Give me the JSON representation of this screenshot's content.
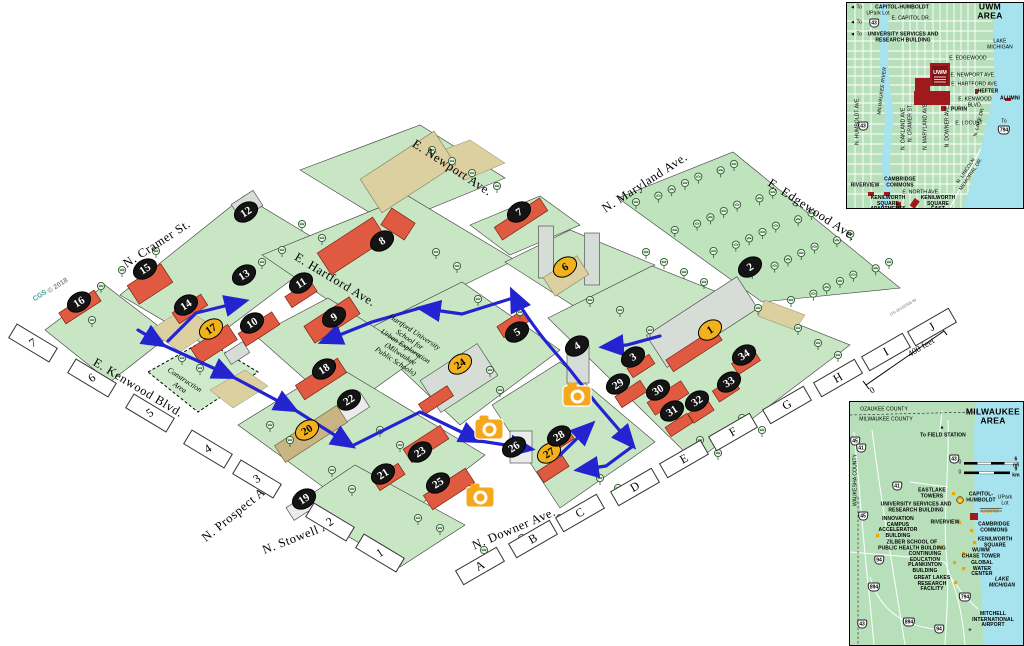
{
  "colors": {
    "route_blue": "#2323cf",
    "marker_yellow": "#f2b21e",
    "marker_black": "#141414",
    "camera_orange": "#f6a81c",
    "land_green": "#c8e6c4",
    "water_cyan": "#a6e3ee",
    "building_coral": "#e05a41",
    "inset_red": "#a01a1d"
  },
  "main_map": {
    "streets": [
      {
        "name": "E. Newport Ave.",
        "x": 452,
        "y": 168,
        "rot": 33
      },
      {
        "name": "N. Maryland Ave.",
        "x": 645,
        "y": 183,
        "rot": -33
      },
      {
        "name": "E. Edgewood Ave.",
        "x": 812,
        "y": 210,
        "rot": 33
      },
      {
        "name": "N. Cramer St.",
        "x": 157,
        "y": 244,
        "rot": -33
      },
      {
        "name": "E. Hartford Ave.",
        "x": 335,
        "y": 280,
        "rot": 31
      },
      {
        "name": "E. Kenwood Blvd.",
        "x": 138,
        "y": 388,
        "rot": 31
      },
      {
        "name": "N. Prospect Ave.",
        "x": 240,
        "y": 510,
        "rot": -39
      },
      {
        "name": "N. Stowell Ave.",
        "x": 304,
        "y": 535,
        "rot": -21
      },
      {
        "name": "N. Downer Ave.",
        "x": 514,
        "y": 529,
        "rot": -23
      }
    ],
    "texts": [
      {
        "t": "CGS",
        "x": 40,
        "y": 296,
        "rot": -33,
        "cls": "wm wm-teal"
      },
      {
        "t": "© 2018",
        "x": 58,
        "y": 286,
        "rot": -33,
        "cls": "wm"
      },
      {
        "t": "Construction\nArea",
        "x": 182,
        "y": 384,
        "rot": 33,
        "cls": "small-italic"
      },
      {
        "t": "Hartford University\nSchool for\nUrban Exploration\n(Milwaukee\nPublic Schools)",
        "x": 405,
        "y": 347,
        "rot": 33,
        "cls": "small-italic"
      },
      {
        "t": "0",
        "x": 872,
        "y": 390,
        "rot": -31,
        "cls": "scale"
      },
      {
        "t": "400 feet",
        "x": 921,
        "y": 347,
        "rot": -31,
        "cls": "scale"
      },
      {
        "t": "GS-20155306-W",
        "x": 903,
        "y": 307,
        "rot": -31,
        "cls": "edge"
      }
    ],
    "grid_numbers": [
      {
        "label": "7",
        "x": 33,
        "y": 343
      },
      {
        "label": "6",
        "x": 92,
        "y": 378
      },
      {
        "label": "5",
        "x": 150,
        "y": 413
      },
      {
        "label": "4",
        "x": 208,
        "y": 449
      },
      {
        "label": "3",
        "x": 257,
        "y": 479
      },
      {
        "label": "2",
        "x": 330,
        "y": 522
      },
      {
        "label": "1",
        "x": 380,
        "y": 553
      }
    ],
    "grid_letters": [
      {
        "label": "A",
        "x": 480,
        "y": 566
      },
      {
        "label": "B",
        "x": 533,
        "y": 539
      },
      {
        "label": "C",
        "x": 580,
        "y": 513
      },
      {
        "label": "D",
        "x": 635,
        "y": 487
      },
      {
        "label": "E",
        "x": 684,
        "y": 459
      },
      {
        "label": "F",
        "x": 733,
        "y": 432
      },
      {
        "label": "G",
        "x": 787,
        "y": 405
      },
      {
        "label": "H",
        "x": 838,
        "y": 378
      },
      {
        "label": "I",
        "x": 886,
        "y": 352
      },
      {
        "label": "J",
        "x": 932,
        "y": 327
      }
    ],
    "markers": [
      {
        "n": "1",
        "x": 710,
        "y": 330,
        "type": "yellow"
      },
      {
        "n": "2",
        "x": 750,
        "y": 267,
        "type": "black"
      },
      {
        "n": "3",
        "x": 633,
        "y": 357,
        "type": "black"
      },
      {
        "n": "4",
        "x": 577,
        "y": 346,
        "type": "black"
      },
      {
        "n": "5",
        "x": 517,
        "y": 332,
        "type": "black"
      },
      {
        "n": "6",
        "x": 565,
        "y": 267,
        "type": "yellow"
      },
      {
        "n": "7",
        "x": 519,
        "y": 212,
        "type": "black"
      },
      {
        "n": "8",
        "x": 382,
        "y": 241,
        "type": "black"
      },
      {
        "n": "9",
        "x": 334,
        "y": 317,
        "type": "black"
      },
      {
        "n": "10",
        "x": 252,
        "y": 323,
        "type": "black"
      },
      {
        "n": "11",
        "x": 301,
        "y": 283,
        "type": "black"
      },
      {
        "n": "12",
        "x": 246,
        "y": 212,
        "type": "black"
      },
      {
        "n": "13",
        "x": 244,
        "y": 275,
        "type": "black"
      },
      {
        "n": "14",
        "x": 186,
        "y": 305,
        "type": "black"
      },
      {
        "n": "15",
        "x": 145,
        "y": 269,
        "type": "black"
      },
      {
        "n": "16",
        "x": 79,
        "y": 302,
        "type": "black"
      },
      {
        "n": "17",
        "x": 211,
        "y": 329,
        "type": "yellow"
      },
      {
        "n": "18",
        "x": 324,
        "y": 369,
        "type": "black"
      },
      {
        "n": "19",
        "x": 304,
        "y": 499,
        "type": "black"
      },
      {
        "n": "20",
        "x": 307,
        "y": 430,
        "type": "yellow"
      },
      {
        "n": "21",
        "x": 383,
        "y": 474,
        "type": "black"
      },
      {
        "n": "22",
        "x": 349,
        "y": 400,
        "type": "black"
      },
      {
        "n": "23",
        "x": 420,
        "y": 452,
        "type": "black"
      },
      {
        "n": "24",
        "x": 460,
        "y": 364,
        "type": "yellow"
      },
      {
        "n": "25",
        "x": 438,
        "y": 483,
        "type": "black"
      },
      {
        "n": "26",
        "x": 514,
        "y": 447,
        "type": "black"
      },
      {
        "n": "27",
        "x": 549,
        "y": 453,
        "type": "yellow"
      },
      {
        "n": "28",
        "x": 559,
        "y": 436,
        "type": "black"
      },
      {
        "n": "29",
        "x": 618,
        "y": 384,
        "type": "black"
      },
      {
        "n": "30",
        "x": 658,
        "y": 390,
        "type": "black"
      },
      {
        "n": "31",
        "x": 672,
        "y": 411,
        "type": "black"
      },
      {
        "n": "32",
        "x": 697,
        "y": 401,
        "type": "black"
      },
      {
        "n": "33",
        "x": 729,
        "y": 382,
        "type": "black"
      },
      {
        "n": "34",
        "x": 744,
        "y": 355,
        "type": "black"
      }
    ],
    "cameras": [
      {
        "x": 577,
        "y": 396
      },
      {
        "x": 489,
        "y": 429
      },
      {
        "x": 480,
        "y": 497
      }
    ]
  },
  "uwm_inset": {
    "title": "UWM AREA",
    "labels": [
      {
        "t": "UWM AREA",
        "x": 143,
        "y": 9,
        "cls": "ttl"
      },
      {
        "t": "◄ To",
        "x": 9,
        "y": 5,
        "cls": "rg"
      },
      {
        "t": "CAPITOL-HUMBOLDT",
        "x": 55,
        "y": 5
      },
      {
        "t": "UPark Lot",
        "x": 31,
        "y": 11,
        "cls": "rg"
      },
      {
        "t": "◄ To",
        "x": 9,
        "y": 20,
        "cls": "rg"
      },
      {
        "t": "E. CAPITOL DR.",
        "x": 64,
        "y": 16,
        "cls": "rg"
      },
      {
        "t": "◄ To",
        "x": 9,
        "y": 32,
        "cls": "rg"
      },
      {
        "t": "UNIVERSITY SERVICES AND\nRESEARCH BUILDING",
        "x": 56,
        "y": 35
      },
      {
        "t": "LAKE\nMICHIGAN",
        "x": 153,
        "y": 42,
        "cls": "rg"
      },
      {
        "t": "E. EDGEWOOD",
        "x": 121,
        "y": 56,
        "cls": "rg"
      },
      {
        "t": "E. NEWPORT AVE.",
        "x": 126,
        "y": 73,
        "cls": "rg"
      },
      {
        "t": "E. HARTFORD AVE.",
        "x": 128,
        "y": 82,
        "cls": "rg"
      },
      {
        "t": "HEFTER",
        "x": 141,
        "y": 89
      },
      {
        "t": "ALUMNI",
        "x": 163,
        "y": 96
      },
      {
        "t": "E. KENWOOD BLVD.",
        "x": 128,
        "y": 100,
        "cls": "rg"
      },
      {
        "t": "PURIN",
        "x": 112,
        "y": 107
      },
      {
        "t": "E. LOCUST",
        "x": 122,
        "y": 121,
        "cls": "rg"
      },
      {
        "t": "N. HUMBOLDT AVE.",
        "x": 11,
        "y": 118,
        "rot": -90,
        "cls": "rg"
      },
      {
        "t": "MILWAUKEE RIVER",
        "x": 36,
        "y": 88,
        "rot": -83,
        "cls": "rg it"
      },
      {
        "t": "N. OAKLAND AVE.",
        "x": 57,
        "y": 125,
        "rot": -90,
        "cls": "rg"
      },
      {
        "t": "N. CRAMER ST.",
        "x": 64,
        "y": 120,
        "rot": -90,
        "cls": "rg"
      },
      {
        "t": "N. MARYLAND AVE.",
        "x": 79,
        "y": 123,
        "rot": -90,
        "cls": "rg"
      },
      {
        "t": "N. DOWNER AVE.",
        "x": 101,
        "y": 123,
        "rot": -90,
        "cls": "rg"
      },
      {
        "t": "N. LAKE DR.",
        "x": 133,
        "y": 119,
        "rot": -75,
        "cls": "rg"
      },
      {
        "t": "To",
        "x": 157,
        "y": 119,
        "cls": "rg"
      },
      {
        "t": "RIVERVIEW",
        "x": 18,
        "y": 183
      },
      {
        "t": "CAMBRIDGE\nCOMMONS",
        "x": 53,
        "y": 180
      },
      {
        "t": "E. NORTH AVE.",
        "x": 74,
        "y": 190,
        "cls": "rg"
      },
      {
        "t": "KENILWORTH\nSQUARE\nAPARTMENTS",
        "x": 41,
        "y": 201
      },
      {
        "t": "KENILWORTH\nSQUARE\nEAST",
        "x": 91,
        "y": 201
      },
      {
        "t": "N. LINCOLN MEMORIAL DR.",
        "x": 122,
        "y": 170,
        "rot": -56,
        "cls": "rg"
      }
    ],
    "shields": [
      {
        "n": "43",
        "x": 27,
        "y": 20
      },
      {
        "n": "43",
        "x": 16,
        "y": 123
      },
      {
        "n": "794",
        "x": 157,
        "y": 127
      }
    ],
    "logo_text": "UWM"
  },
  "mke_inset": {
    "title": "MILWAUKEE\nAREA",
    "labels": [
      {
        "t": "MILWAUKEE\nAREA",
        "x": 143,
        "y": 15,
        "cls": "ttl"
      },
      {
        "t": "OZAUKEE COUNTY",
        "x": 34,
        "y": 8,
        "cls": "rg"
      },
      {
        "t": "MILWAUKEE COUNTY",
        "x": 36,
        "y": 18,
        "cls": "rg"
      },
      {
        "t": "▲",
        "x": 92,
        "y": 26,
        "cls": "rg"
      },
      {
        "t": "To FIELD STATION",
        "x": 93,
        "y": 34
      },
      {
        "t": "WAUKESHA COUNTY",
        "x": 6,
        "y": 78,
        "rot": -90,
        "cls": "rg"
      },
      {
        "t": "0",
        "x": 110,
        "y": 61,
        "cls": "rg"
      },
      {
        "t": "6 mi",
        "x": 166,
        "y": 61
      },
      {
        "t": "0",
        "x": 110,
        "y": 71,
        "cls": "rg"
      },
      {
        "t": "9 km",
        "x": 166,
        "y": 71
      },
      {
        "t": "EASTLAKE\nTOWERS",
        "x": 82,
        "y": 92
      },
      {
        "t": "CAPITOL-\nHUMBOLDT",
        "x": 131,
        "y": 96
      },
      {
        "t": "UPark Lot",
        "x": 155,
        "y": 99,
        "cls": "rg"
      },
      {
        "t": "UNIVERSITY SERVICES AND\nRESEARCH BUILDING",
        "x": 66,
        "y": 106
      },
      {
        "t": "INNOVATION\nCAMPUS\nACCELERATOR\nBUILDING",
        "x": 48,
        "y": 126
      },
      {
        "t": "RIVERVIEW",
        "x": 95,
        "y": 121
      },
      {
        "t": "CAMBRIDGE\nCOMMONS",
        "x": 144,
        "y": 126
      },
      {
        "t": "KENILWORTH\nSQUARE",
        "x": 145,
        "y": 141
      },
      {
        "t": "ZILBER SCHOOL OF\nPUBLIC HEALTH BUILDING",
        "x": 62,
        "y": 144
      },
      {
        "t": "CONTINUING\nEDUCATION\nPLANKINTON\nBUILDING",
        "x": 75,
        "y": 161
      },
      {
        "t": "WUWM\nCHASE TOWER",
        "x": 131,
        "y": 152
      },
      {
        "t": "GLOBAL WATER\nCENTER",
        "x": 132,
        "y": 167
      },
      {
        "t": "GREAT LAKES\nRESEARCH\nFACILITY",
        "x": 82,
        "y": 182
      },
      {
        "t": "LAKE\nMICHIGAN",
        "x": 152,
        "y": 181,
        "cls": "it"
      },
      {
        "t": "MITCHELL\nINTERNATIONAL\nAIRPORT",
        "x": 143,
        "y": 218
      },
      {
        "t": "✈",
        "x": 120,
        "y": 229,
        "cls": "rg"
      }
    ],
    "shields": [
      {
        "n": "45",
        "x": 5,
        "y": 39
      },
      {
        "n": "41",
        "x": 11,
        "y": 46
      },
      {
        "n": "43",
        "x": 104,
        "y": 57
      },
      {
        "n": "41",
        "x": 47,
        "y": 84
      },
      {
        "n": "45",
        "x": 13,
        "y": 114
      },
      {
        "n": "94",
        "x": 29,
        "y": 158
      },
      {
        "n": "894",
        "x": 24,
        "y": 185
      },
      {
        "n": "794",
        "x": 115,
        "y": 195
      },
      {
        "n": "894",
        "x": 59,
        "y": 220
      },
      {
        "n": "43",
        "x": 12,
        "y": 222
      },
      {
        "n": "94",
        "x": 89,
        "y": 227
      }
    ],
    "logo_text": "UWM"
  }
}
